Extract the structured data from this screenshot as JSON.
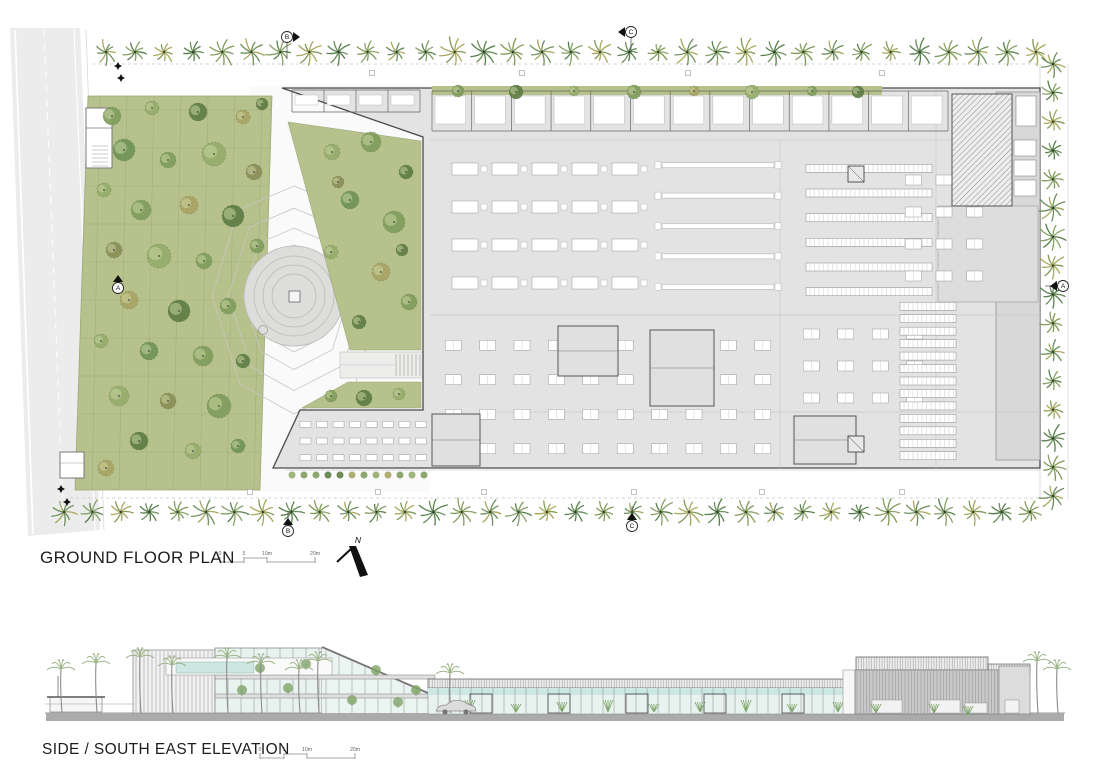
{
  "plan": {
    "title": "GROUND FLOOR PLAN",
    "scalebar": {
      "labels": [
        "0",
        "5",
        "10m",
        "20m"
      ],
      "x": 220,
      "y": 562
    },
    "north": {
      "label": "N"
    },
    "section_markers": [
      {
        "label": "B",
        "x": 287,
        "y": 37,
        "flag": "e",
        "leader": "s"
      },
      {
        "label": "C",
        "x": 631,
        "y": 32,
        "flag": "w",
        "leader": "s"
      },
      {
        "label": "A",
        "x": 118,
        "y": 288,
        "flag": "n",
        "leader": null
      },
      {
        "label": "A",
        "x": 1063,
        "y": 286,
        "flag": "w",
        "leader": "w"
      },
      {
        "label": "B",
        "x": 288,
        "y": 531,
        "flag": "n",
        "leader": "n"
      },
      {
        "label": "C",
        "x": 632,
        "y": 526,
        "flag": "n",
        "leader": "n"
      }
    ],
    "palm_rows": {
      "top": {
        "x1": 106,
        "x2": 1036,
        "y": 52,
        "n": 33
      },
      "bottom": {
        "x1": 64,
        "x2": 1030,
        "y": 512,
        "n": 35
      },
      "right": {
        "x": 1053,
        "y1": 64,
        "y2": 496,
        "n": 16
      }
    },
    "garden_trees": [
      [
        112,
        116,
        9,
        0
      ],
      [
        152,
        108,
        7,
        1
      ],
      [
        198,
        112,
        9,
        2
      ],
      [
        243,
        117,
        7,
        3
      ],
      [
        262,
        104,
        6,
        2
      ],
      [
        124,
        150,
        11,
        4
      ],
      [
        168,
        160,
        8,
        0
      ],
      [
        214,
        154,
        12,
        1
      ],
      [
        254,
        172,
        8,
        5
      ],
      [
        104,
        190,
        7,
        1
      ],
      [
        141,
        210,
        10,
        0
      ],
      [
        189,
        205,
        9,
        3
      ],
      [
        233,
        216,
        11,
        2
      ],
      [
        257,
        246,
        7,
        0
      ],
      [
        114,
        250,
        8,
        5
      ],
      [
        159,
        256,
        12,
        1
      ],
      [
        204,
        261,
        8,
        0
      ],
      [
        129,
        300,
        9,
        3
      ],
      [
        179,
        311,
        11,
        2
      ],
      [
        228,
        306,
        8,
        0
      ],
      [
        101,
        341,
        7,
        1
      ],
      [
        149,
        351,
        9,
        4
      ],
      [
        203,
        356,
        10,
        0
      ],
      [
        243,
        361,
        7,
        2
      ],
      [
        119,
        396,
        10,
        1
      ],
      [
        168,
        401,
        8,
        5
      ],
      [
        219,
        406,
        12,
        0
      ],
      [
        139,
        441,
        9,
        2
      ],
      [
        193,
        451,
        8,
        1
      ],
      [
        238,
        446,
        7,
        4
      ],
      [
        106,
        468,
        8,
        3
      ]
    ],
    "upper_lawn_trees": [
      [
        332,
        152,
        8,
        1
      ],
      [
        371,
        142,
        10,
        0
      ],
      [
        406,
        172,
        7,
        2
      ],
      [
        350,
        200,
        9,
        4
      ],
      [
        394,
        222,
        11,
        0
      ],
      [
        331,
        252,
        7,
        1
      ],
      [
        381,
        272,
        9,
        3
      ],
      [
        409,
        302,
        8,
        0
      ],
      [
        359,
        322,
        7,
        2
      ],
      [
        338,
        182,
        6,
        5
      ],
      [
        402,
        250,
        6,
        2
      ]
    ],
    "lower_lawn_trees": [
      [
        331,
        396,
        6,
        0
      ],
      [
        364,
        398,
        8,
        2
      ],
      [
        399,
        394,
        6,
        1
      ]
    ],
    "courtyard_trees": [
      [
        458,
        91,
        6,
        0
      ],
      [
        516,
        92,
        7,
        2
      ],
      [
        574,
        91,
        5,
        1
      ],
      [
        634,
        92,
        7,
        0
      ],
      [
        694,
        91,
        5,
        3
      ],
      [
        752,
        92,
        7,
        1
      ],
      [
        812,
        91,
        5,
        0
      ],
      [
        858,
        92,
        6,
        2
      ]
    ],
    "entrance_markers": [
      [
        118,
        66
      ],
      [
        121,
        78
      ],
      [
        61,
        489
      ],
      [
        67,
        502
      ]
    ],
    "path_squares": [
      [
        372,
        73
      ],
      [
        522,
        73
      ],
      [
        688,
        73
      ],
      [
        882,
        73
      ],
      [
        250,
        492
      ],
      [
        378,
        492
      ],
      [
        484,
        492
      ],
      [
        634,
        492
      ],
      [
        762,
        492
      ],
      [
        902,
        492
      ]
    ],
    "furniture_zones": [
      {
        "t": "rooms",
        "x": 432,
        "y": 91,
        "w": 516,
        "h": 40,
        "n": 13
      },
      {
        "t": "rooms",
        "x": 292,
        "y": 90,
        "w": 128,
        "h": 22,
        "n": 4
      },
      {
        "t": "machines",
        "x": 452,
        "y": 150,
        "w": 200,
        "h": 152,
        "rows": 4
      },
      {
        "t": "bars",
        "x": 662,
        "y": 150,
        "w": 112,
        "h": 152,
        "rows": 5
      },
      {
        "t": "racks",
        "x": 806,
        "y": 156,
        "w": 126,
        "h": 148,
        "rows": 6
      },
      {
        "t": "grid",
        "x": 436,
        "y": 328,
        "w": 344,
        "h": 138,
        "rows": 4,
        "cols": 10
      },
      {
        "t": "grid",
        "x": 794,
        "y": 318,
        "w": 138,
        "h": 96,
        "rows": 3,
        "cols": 4
      },
      {
        "t": "racks",
        "x": 900,
        "y": 300,
        "w": 56,
        "h": 162,
        "rows": 13
      },
      {
        "t": "grid",
        "x": 898,
        "y": 164,
        "w": 92,
        "h": 128,
        "rows": 4,
        "cols": 3
      },
      {
        "t": "tables",
        "x": 298,
        "y": 416,
        "w": 132,
        "h": 50,
        "rows": 3,
        "cols": 8
      }
    ],
    "outlined_rooms": [
      [
        558,
        326,
        60,
        50
      ],
      [
        650,
        330,
        64,
        76
      ],
      [
        432,
        414,
        48,
        52
      ],
      [
        794,
        416,
        62,
        48
      ]
    ],
    "cores": [
      [
        848,
        166,
        16,
        16
      ],
      [
        848,
        436,
        16,
        16
      ]
    ],
    "white_blocks": [
      [
        1014,
        140,
        22,
        16
      ],
      [
        1014,
        160,
        22,
        16
      ],
      [
        1014,
        180,
        22,
        16
      ],
      [
        1016,
        96,
        20,
        30
      ]
    ],
    "hatch_block": [
      952,
      94,
      60,
      112
    ]
  },
  "elevation": {
    "title": "SIDE / SOUTH EAST ELEVATION",
    "scalebar": {
      "labels": [
        "0",
        "5",
        "10m",
        "20m"
      ],
      "x": 260,
      "y": 758
    },
    "palms": [
      [
        62,
        44
      ],
      [
        97,
        50
      ],
      [
        141,
        56
      ],
      [
        173,
        48
      ],
      [
        228,
        56
      ],
      [
        262,
        50
      ],
      [
        300,
        44
      ],
      [
        319,
        52
      ],
      [
        451,
        40
      ],
      [
        1038,
        52
      ],
      [
        1058,
        44
      ]
    ],
    "glass_plants": {
      "x1": 470,
      "x2": 838,
      "step": 46
    },
    "interior_trees": [
      [
        242,
        690
      ],
      [
        260,
        668
      ],
      [
        288,
        688
      ],
      [
        306,
        664
      ],
      [
        352,
        700
      ],
      [
        376,
        670
      ],
      [
        398,
        702
      ],
      [
        416,
        690
      ]
    ],
    "doors": [
      470,
      548,
      626,
      704,
      782
    ],
    "right_openings": [
      [
        872,
        700,
        30,
        13
      ],
      [
        930,
        700,
        30,
        13
      ],
      [
        965,
        703,
        22,
        10
      ]
    ],
    "right_plants": [
      [
        876,
        703
      ],
      [
        934,
        703
      ],
      [
        968,
        705
      ]
    ],
    "car": {
      "x": 436,
      "y": 705
    }
  },
  "colors": {
    "lawn": "#b7c18c",
    "lawnLine": "#98a46f",
    "treeLight": "#cdd8a4",
    "trees": [
      "#7f9d5d",
      "#94ac6c",
      "#5d7d45",
      "#a8a465",
      "#6f9458",
      "#8a8f57"
    ],
    "palms": [
      "#6c8f5c",
      "#86a065",
      "#a8a75e",
      "#57804c",
      "#7f9a55"
    ],
    "road": "#ececec",
    "plaza": "#fafafa",
    "slab": "#e3e3e3",
    "roomDark": "#d8d8d8",
    "wall": "#4a4a4a",
    "contour": "#c6c6c4",
    "amphi": "#dddddc",
    "glass": "#e8f3f0",
    "cyan": "#cde7e2",
    "parapet": "#f3f3f3",
    "facade": "#c9c9c9",
    "ground": "#ababab",
    "hatch": "#777777"
  }
}
